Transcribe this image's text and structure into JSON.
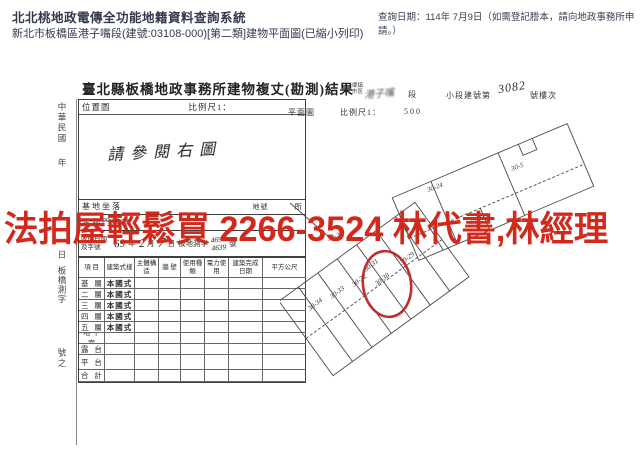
{
  "colors": {
    "watermark_red": "#d3291d",
    "circle_red": "#c62b2b",
    "ink": "#2d2d2d",
    "ui_text": "#333a4e"
  },
  "topbar": {
    "system_title": "北北桃地政電傳全功能地籍資料查詢系統",
    "query_date": "查詢日期：114年 7月9日（如需登記謄本，請向地政事務所申請。）",
    "subtitle": "新北市板橋區港子嘴段(建號:03108-000)[第二類]建物平面圖(已縮小列印)"
  },
  "watermark": "法拍屋輕鬆買 2266-3524 林代書,林經理",
  "doc": {
    "title": "臺北縣板橋地政事務所建物複丈(勘測)結果",
    "margin": {
      "era": "中華民國",
      "year": "年",
      "day": "日",
      "file": "板橋測字",
      "no": "號之"
    },
    "location": {
      "label": "位置圖",
      "scale": "比例尺1：",
      "note": "請參閱右圖"
    },
    "plan_head": {
      "township": "鄉鎮市區",
      "section_hand": "港子嘴",
      "section": "段",
      "bno_label": "小段建號第",
      "bno_hand": "3082",
      "bno_suffix": "號樓次",
      "plan": "平面圖",
      "scale": "比例尺1：",
      "scale_val": "500"
    },
    "site_row": {
      "label": "基地坐落",
      "mid": "地號",
      "right": "所"
    },
    "door_row": {
      "label": "建物門牌",
      "mid": "",
      "right": "號"
    },
    "receipt": {
      "label1": "收件日期",
      "label2": "及字號",
      "y": "69",
      "year": "年",
      "m": "2",
      "month": "月",
      "d": "7",
      "day": "日",
      "office": "板地測字",
      "no1": "4690",
      "no2": "4639",
      "suffix": "號"
    },
    "grid": {
      "headers": [
        "項 目",
        "建築式樣",
        "主體構造",
        "牆 壁",
        "使用種類",
        "電力使用",
        "建築完成日期",
        "平方公尺"
      ],
      "rows": [
        {
          "item": "基 層",
          "style": "本國式"
        },
        {
          "item": "二 層",
          "style": "本國式"
        },
        {
          "item": "三 層",
          "style": "本國式"
        },
        {
          "item": "四 層",
          "style": "本國式"
        },
        {
          "item": "五 層",
          "style": "本國式"
        },
        {
          "item": "地下室",
          "style": ""
        },
        {
          "item": "露 台",
          "style": ""
        },
        {
          "item": "平 台",
          "style": ""
        },
        {
          "item": "合 計",
          "style": ""
        }
      ]
    }
  },
  "plan": {
    "labels": [
      {
        "text": "30-24"
      },
      {
        "text": "30-5"
      },
      {
        "text": "30-23"
      },
      {
        "text": "30-25"
      },
      {
        "text": "30-34"
      },
      {
        "text": "30-33"
      },
      {
        "text": "30-32"
      },
      {
        "text": "30-31"
      },
      {
        "text": "30-30"
      },
      {
        "text": "30-29"
      }
    ]
  }
}
